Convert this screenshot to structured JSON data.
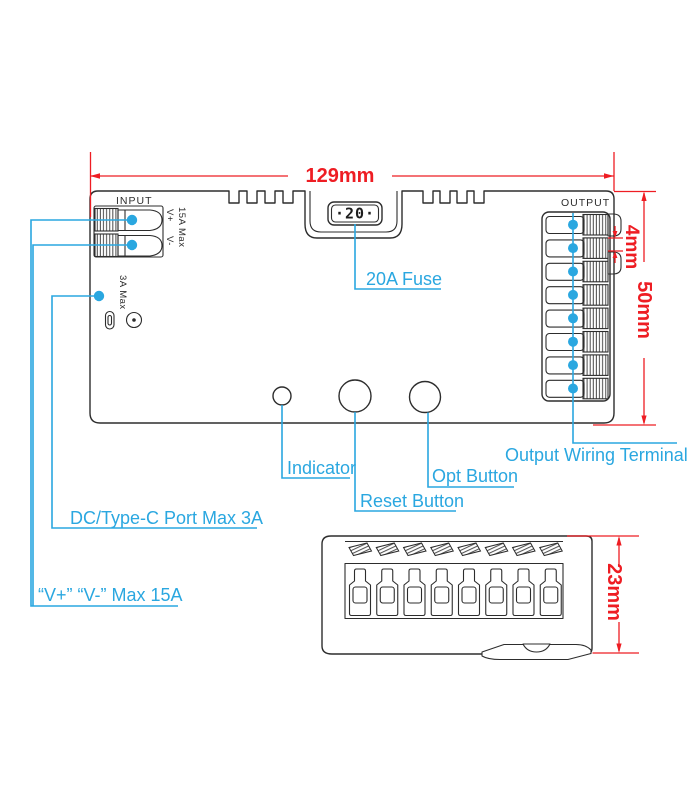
{
  "figure": {
    "top_dim": "129mm",
    "gap_dim": "4mm",
    "height_dim": "50mm",
    "side_dim": "23mm",
    "input_label": "INPUT",
    "output_label": "OUTPUT",
    "fuse_display": "·20·",
    "v_plus": "V+",
    "v_minus": "V-",
    "input_max": "15A Max",
    "usb_max": "3A Max"
  },
  "annotations": {
    "fuse": "20A Fuse",
    "indicator": "Indicator",
    "reset": "Reset Button",
    "opt": "Opt Button",
    "output_terminal": "Output Wiring Terminal",
    "typec": "DC/Type-C Port Max 3A",
    "input_rating": "“V+” “V-” Max 15A"
  },
  "colors": {
    "annotation": "#2aa7e0",
    "dimension": "#ee1d23",
    "outline": "#2d2d2d"
  }
}
